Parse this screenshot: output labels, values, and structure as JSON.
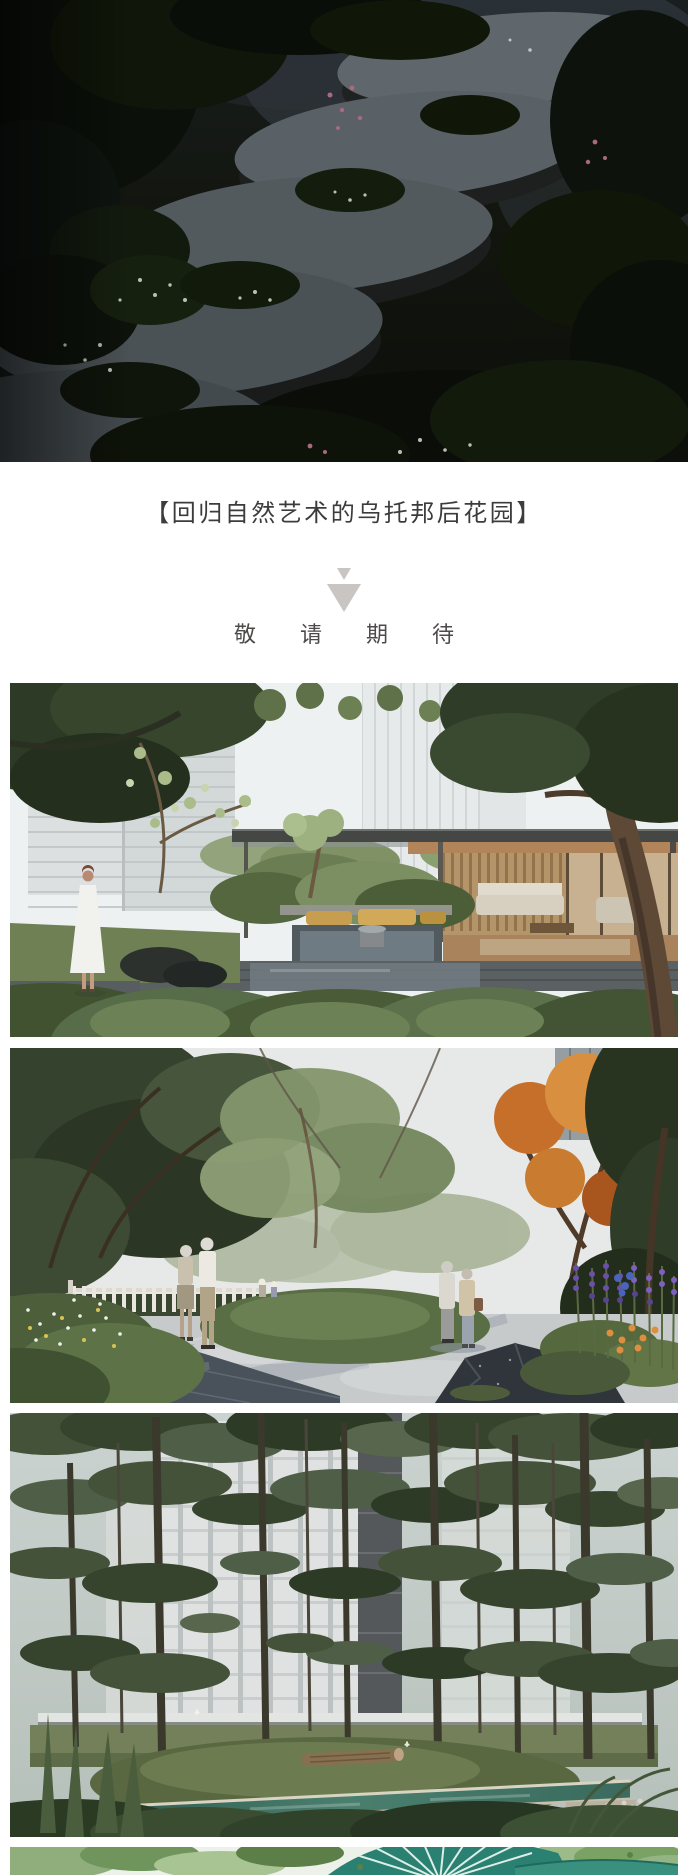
{
  "article": {
    "section_title": "【回归自然艺术的乌托邦后花园】",
    "teaser_text": "敬请期待",
    "divider_icon": "double-chevron-down-icon",
    "title_color": "#3c3c3c",
    "teaser_color": "#4d4a4a",
    "divider_icon_color": "#c8c5c2",
    "page_background": "#ffffff"
  },
  "photos": [
    {
      "description": "Night garden rendering: large round stone stepping pads climbing through dark foliage with tiny white and pink blossoms, blurred building light in the background"
    },
    {
      "description": "Daytime courtyard rendering: residential towers behind a flat-roofed glass pavilion with wood interior and sofas, sunken lounge with golden cushions and water feature, mounded shrubs, woman in white dress standing on the lawn"
    },
    {
      "description": "Garden path rendering: elderly couples strolling on a light stone plaza, white picket fence, green mounds, orange autumn tree, dark rocks and purple flower spikes"
    },
    {
      "description": "Woodland rendering: slender pine trunks in front of apartment buildings, lawn mound with a log, narrow teal reflecting channel with stone edges, ferns and butterflies"
    },
    {
      "description": "Partially visible photo: treetop foliage with a teal curved slatted canopy structure"
    }
  ]
}
